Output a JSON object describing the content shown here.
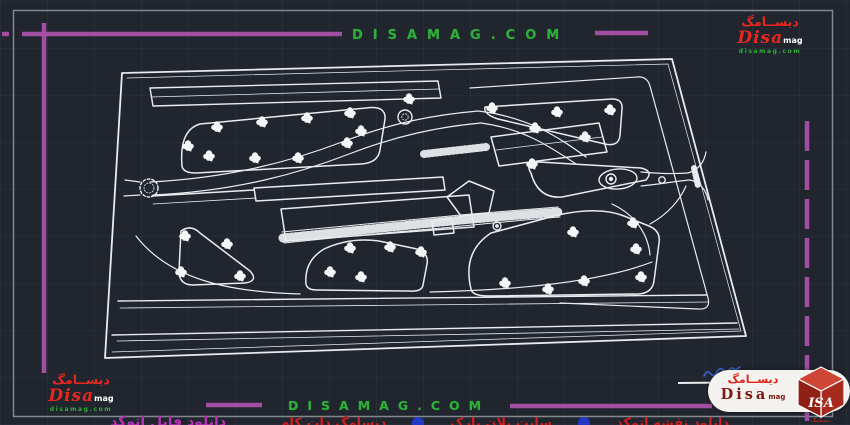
{
  "watermarks": {
    "top": "DISAMAG.COM",
    "bottom": "DISAMAG.COM"
  },
  "logo": {
    "persian": "دیســامگ",
    "name": "Disa",
    "suffix": "mag",
    "site": "disamag.com"
  },
  "badge": {
    "persian": "دیســامگ",
    "name": "Disa",
    "suffix": "mag",
    "cube_text": "ISA",
    "cube_caption": "دیسامگ"
  },
  "clipped": {
    "magenta": "دانلود فایل اتوکد",
    "red_a": "دانلود نقشه اتوکد",
    "red_b": "سایت پلان پارک",
    "red_c": "دیسامگ دات کام"
  },
  "colors": {
    "background": "#20252e",
    "drawing_line": "#e9ebee",
    "frame_purple": "#a14ea3",
    "watermark_green": "#2fae3a",
    "logo_red": "#e8281e",
    "signature_blue": "#3e63cf",
    "caption_magenta": "#b82fb8",
    "caption_red": "#d31c1c",
    "sheet_border_gray": "#83888f"
  },
  "plan": {
    "trees": [
      [
        217,
        127
      ],
      [
        262,
        122
      ],
      [
        307,
        118
      ],
      [
        350,
        113
      ],
      [
        188,
        146
      ],
      [
        209,
        156
      ],
      [
        255,
        158
      ],
      [
        298,
        158
      ],
      [
        347,
        143
      ],
      [
        361,
        131
      ],
      [
        492,
        108
      ],
      [
        557,
        112
      ],
      [
        610,
        110
      ],
      [
        535,
        128
      ],
      [
        585,
        137
      ],
      [
        532,
        164
      ],
      [
        409,
        99
      ],
      [
        185,
        236
      ],
      [
        227,
        244
      ],
      [
        181,
        272
      ],
      [
        240,
        276
      ],
      [
        330,
        272
      ],
      [
        361,
        277
      ],
      [
        350,
        248
      ],
      [
        390,
        247
      ],
      [
        421,
        252
      ],
      [
        505,
        283
      ],
      [
        548,
        289
      ],
      [
        573,
        232
      ],
      [
        633,
        223
      ],
      [
        636,
        249
      ],
      [
        584,
        281
      ],
      [
        641,
        277
      ]
    ]
  }
}
